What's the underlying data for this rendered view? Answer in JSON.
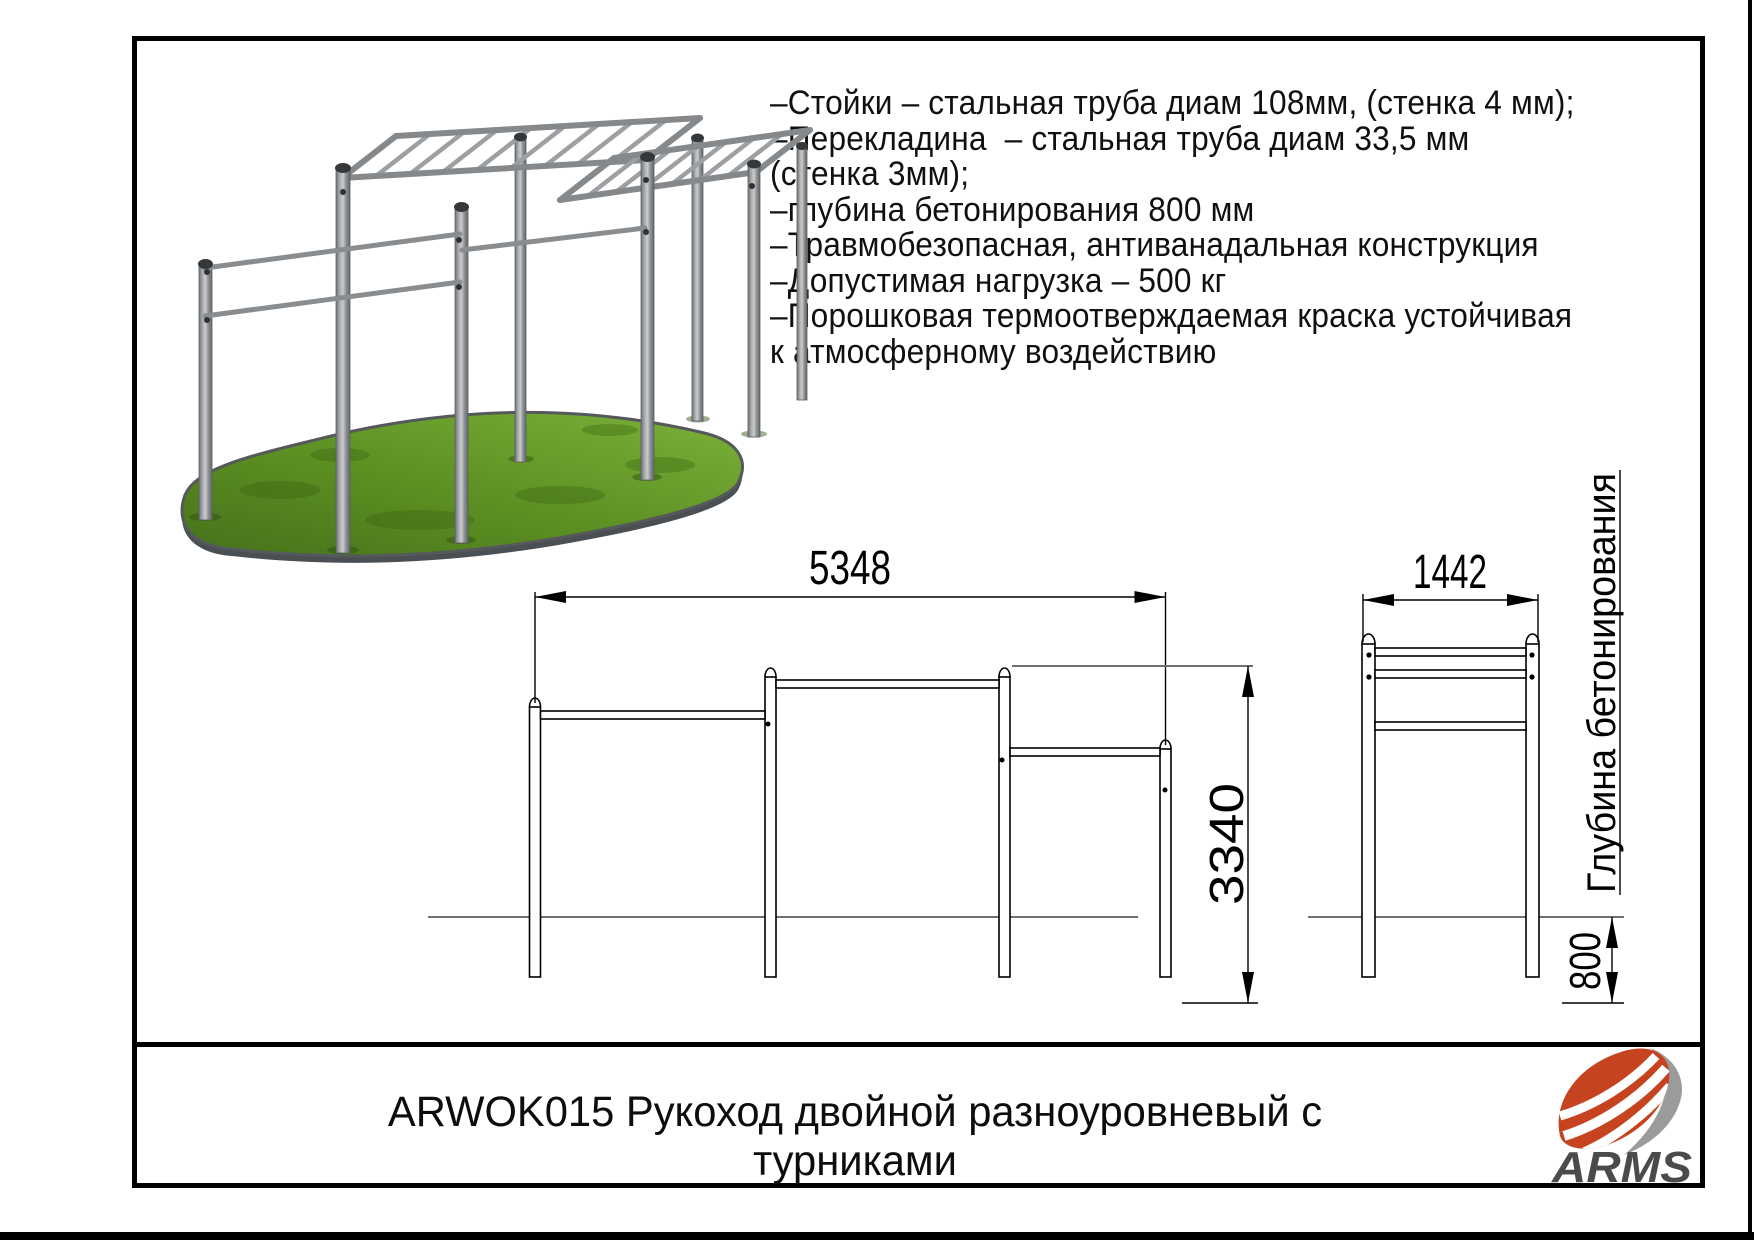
{
  "specs": {
    "lines": [
      "–Стойки – стальная труба диам 108мм, (стенка 4 мм);",
      "–Перекладина  – стальная труба диам 33,5 мм",
      "(стенка 3мм);",
      "–глубина бетонирования 800 мм",
      "–Травмобезопасная, антиванадальная конструкция",
      "–Допустимая нагрузка – 500 кг",
      "–Порошковая термоотверждаемая краска устойчивая",
      "к атмосферному воздействию"
    ]
  },
  "front_view": {
    "width_label": "5348",
    "height_label": "3340"
  },
  "side_view": {
    "width_label": "1442",
    "footing_label": "800",
    "footing_caption": "Глубина бетонирования"
  },
  "title_block": {
    "code_and_name": "ARWOK015 Рукоход двойной разноуровневый с турниками"
  },
  "logo": {
    "brand": "ARMS"
  },
  "colors": {
    "drawing_line": "#000000",
    "ground_line": "#707070",
    "grass_light": "#79ad36",
    "grass_dark": "#3e6c10",
    "metal": "#8e9296",
    "logo_red": "#c5431e",
    "logo_gray": "#9b9b9b",
    "logo_text": "#4b4b4b"
  }
}
